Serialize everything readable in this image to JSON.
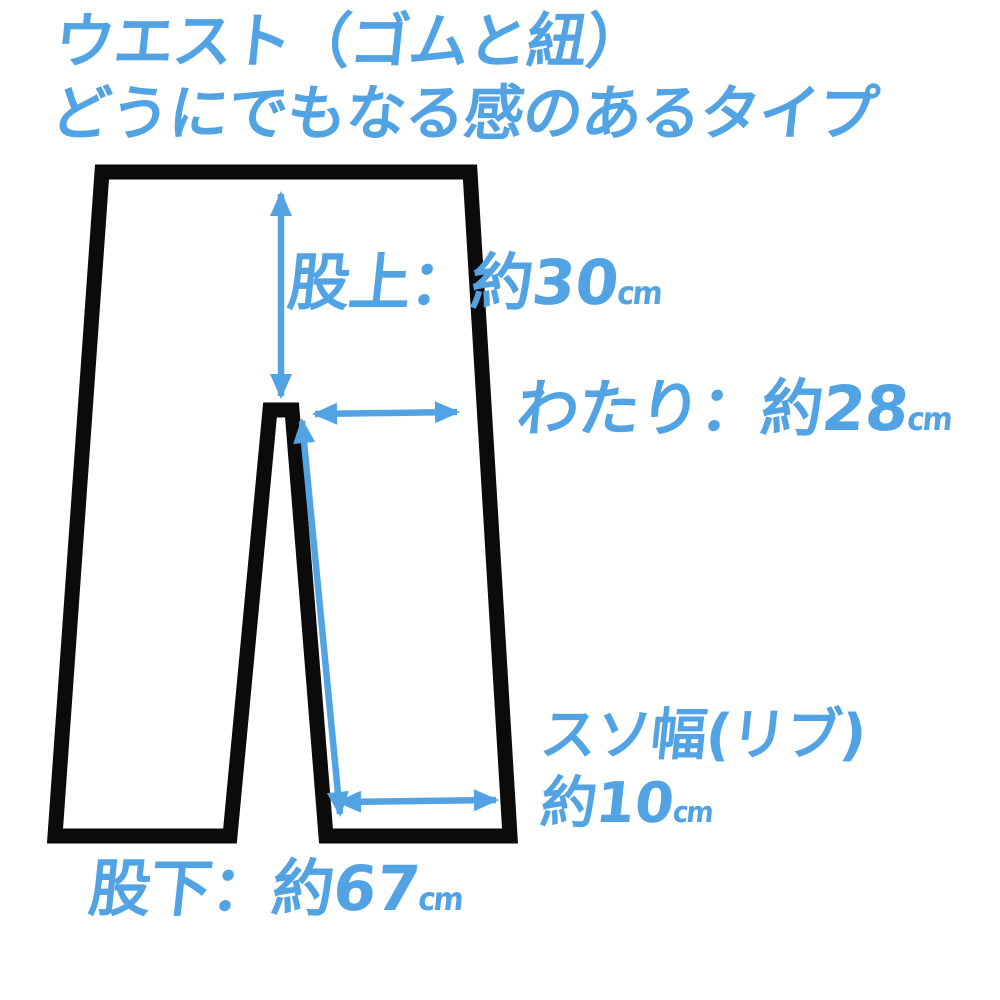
{
  "colors": {
    "accent": "#52a3e4",
    "outline": "#0b0b0b",
    "background": "#ffffff"
  },
  "title": {
    "line1": "ウエスト（ゴムと紐）",
    "line2": "どうにでもなる感のあるタイプ"
  },
  "measurements": {
    "rise": {
      "name": "股上",
      "label": "股上：約",
      "value": "30",
      "unit": "cm"
    },
    "thigh": {
      "name": "わたり",
      "label": "わたり：約",
      "value": "28",
      "unit": "cm"
    },
    "hem": {
      "name": "スソ幅",
      "title": "スソ幅(リブ)",
      "label": "約",
      "value": "10",
      "unit": "cm"
    },
    "inseam": {
      "name": "股下",
      "label": "股下：約",
      "value": "67",
      "unit": "cm"
    }
  }
}
